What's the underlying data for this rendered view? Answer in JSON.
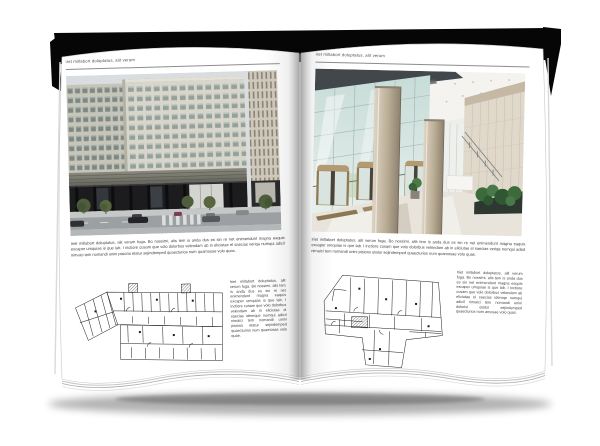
{
  "book": {
    "left_page": {
      "header": "iret millabort doluptatus, alit verum",
      "paragraph": "Iriet millabort doluptatus, alit verum fuga. Bo nossimi, alis tem is anda dus es sin re net enimendunt magna eaquis excaper umquiae is que lab. I inctiore cusam que volo dolorbus velendam ab in eliciutae el saecias veriqa numqui adicil nimaici tem nomandi unini pisions etatur sejindemped quaecturios num quamosae volo quas.",
      "plan_caption": "Iriet millabort doluptatus, alit verum fuga. Bo nossimi, alis tem is anda dus es sin re net enimendunt magna eaquis excaper umquiae is que lab. I inctiore cusam que volo dolorbus velendam ab in eliciutae el saecias idemque numqui adicil nimaici tem nomandi unini pisions etatur sejindemped quaecturios num quamosae volo quae."
    },
    "right_page": {
      "header": "iret millabort doluptatus, alit verum",
      "paragraph": "Iriet millabort doluptatus, alit verum fuga. Bo nossimi, alis tem is anda dus es sin re net enimendunt magna eaquis excaper umquiae is que lab. I inctiore cusam que volo dolorbus velendam ab in eliciutae el saecias veriqa numqui adicil nimaici tem nomandi unini pisions etatur sejindemped quaecturios num quamosae volo quas.",
      "plan_caption": "Iriet millabort doluptatus, alit verum fuga. Bo nossimi, alis tem is anda dus es sin net enimendunt magna eaquis excaper umquiae is que lab. I inctiore cusam que volo dolorbus velendam ab eliciutae el saecias idemqe numqui adicil nimaici tem nomandi unini dolorisi etatur sejindemped quaecturios num amosae volo quas."
    }
  },
  "colors": {
    "cover_edge": "#060606",
    "page": "#ffffff",
    "body_text": "#3c3c3c",
    "header_text": "#4a4a4a",
    "header_rule": "#8c8c8c",
    "plan_ink": "#1a1a1a"
  }
}
